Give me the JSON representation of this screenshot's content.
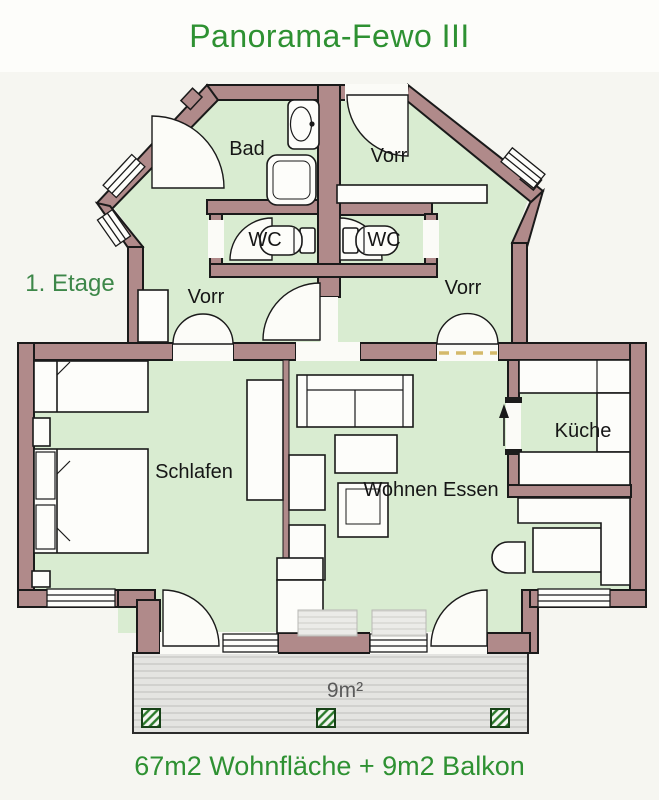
{
  "title": "Panorama-Fewo III",
  "floor_label": "1. Etage",
  "caption": "67m2 Wohnfläche + 9m2 Balkon",
  "labels": {
    "bad": "Bad",
    "vorr_top": "Vorr",
    "wc_left": "WC",
    "wc_right": "WC",
    "vorr_left": "Vorr",
    "vorr_right": "Vorr",
    "schlafen": "Schlafen",
    "wohnen_essen": "Wohnen Essen",
    "kueche": "Küche",
    "balcony_area": "9m²"
  },
  "colors": {
    "wall": "#b08a8a",
    "floor": "#d9ecd1",
    "title_green": "#2e9132",
    "etage_green": "#3d8749",
    "balcony_fill": "#e4e4e1",
    "hatch_green": "#2a7a2a",
    "dashed_accent": "#d4b96a"
  }
}
